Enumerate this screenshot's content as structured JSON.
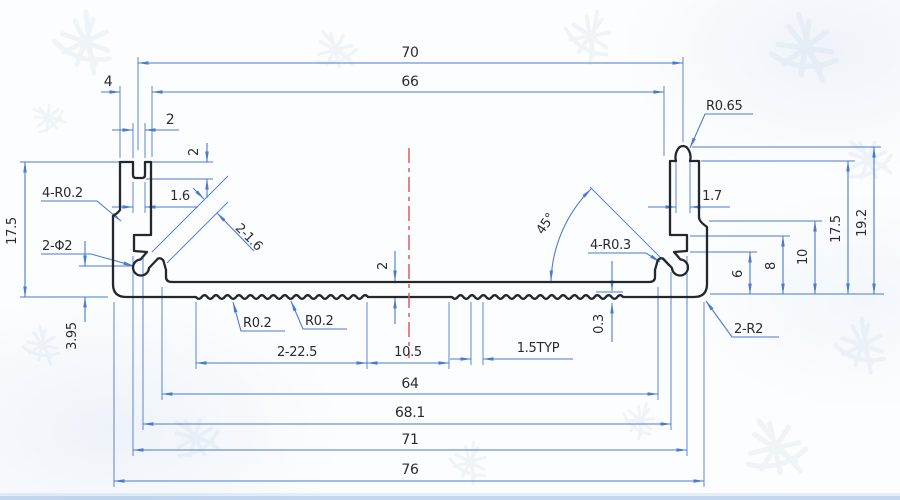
{
  "drawing": {
    "type": "engineering-cross-section",
    "subject": "aluminum extrusion profile",
    "colors": {
      "dimension": "#4a7bd0",
      "outline": "#23272e",
      "centerline": "#e25a5a",
      "text": "#2a2a32",
      "watermark": "#a9c3de"
    },
    "labels": {
      "overall_top": "70",
      "inner_width": "66",
      "wall_width": "4",
      "slot_width": "2",
      "slot_depth": "2",
      "slot_width_lower": "1.6",
      "radius_top_boss": "R0.65",
      "boss_width": "1.7",
      "fillet_left": "4-R0.2",
      "hole_left": "2-Φ2",
      "height_left": "17.5",
      "hole_height": "3.95",
      "slot_diag": "2-1.6",
      "plate_thickness": "2",
      "angle": "45°",
      "fillet_right": "4-R0.3",
      "radius_serr_a": "R0.2",
      "radius_serr_b": "R0.2",
      "serration_depth": "0.3",
      "serration_pitch": "1.5TYP",
      "serrated_width": "2-22.5",
      "middle_width": "10.5",
      "width_64": "64",
      "width_68": "68.1",
      "width_71": "71",
      "width_76": "76",
      "step_6": "6",
      "step_8": "8",
      "step_10": "10",
      "height_right": "17.5",
      "height_total": "19.2",
      "corner_radius": "2-R2"
    }
  }
}
